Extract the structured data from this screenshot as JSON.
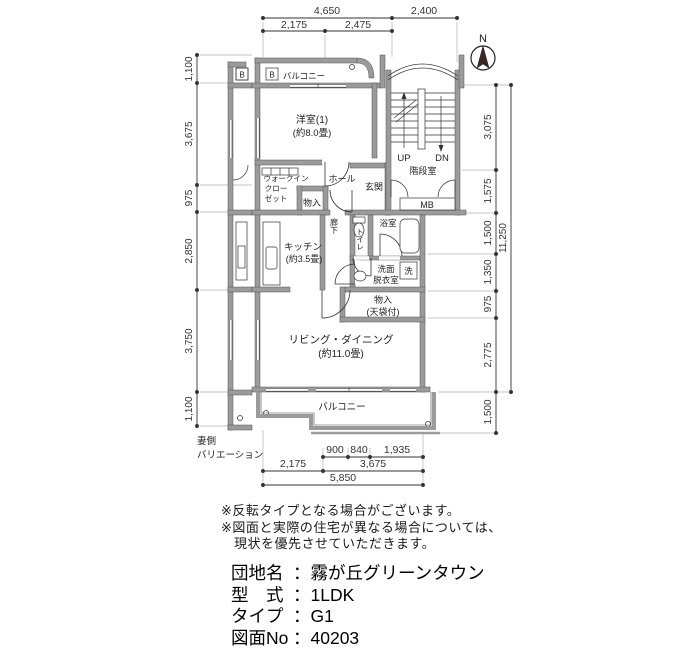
{
  "plan": {
    "compass": "N",
    "marker_b": "B",
    "rooms": {
      "balcony_top": "バルコニー",
      "western_room": "洋室(1)",
      "western_room_size": "(約8.0畳)",
      "wic_line1": "ウォークイン",
      "wic_line2": "クロー",
      "wic_line3": "ゼット",
      "storage_hall": "物入",
      "hall": "ホール",
      "entrance": "玄関",
      "stair_up": "UP",
      "stair_down": "DN",
      "stairwell": "階段室",
      "meter_box": "MB",
      "kitchen": "キッチン",
      "kitchen_size": "(約3.5畳)",
      "corridor": "廊下",
      "toilet": "トイレ",
      "bath": "浴室",
      "washroom_line1": "洗面",
      "washroom_line2": "脱衣室",
      "washer": "洗",
      "storage_living": "物入",
      "storage_living_note": "(天袋付)",
      "living": "リビング・ダイニング",
      "living_size": "(約11.0畳)",
      "balcony_bottom": "バルコニー"
    },
    "dims": {
      "top_row1": [
        "4,650",
        "2,400"
      ],
      "top_row2": [
        "2,175",
        "2,475"
      ],
      "left": [
        "1,100",
        "3,675",
        "975",
        "2,850",
        "3,750",
        "1,100"
      ],
      "right": [
        "3,075",
        "1,575",
        "1,500",
        "1,350",
        "975",
        "2,775",
        "1,500"
      ],
      "right_total": "11,250",
      "bottom_row1": [
        "900",
        "840",
        "1,935"
      ],
      "bottom_row2": [
        "2,175",
        "3,675"
      ],
      "bottom_row3": [
        "5,850"
      ]
    },
    "side_label_line1": "妻側",
    "side_label_line2": "バリエーション"
  },
  "notes": {
    "line1": "※反転タイプとなる場合がございます。",
    "line2": "※図面と実際の住宅が異なる場合については、",
    "line3": "現状を優先させていただきます。"
  },
  "info": {
    "separator": "：",
    "rows": [
      {
        "label": "団地名",
        "value": "霧が丘グリーンタウン"
      },
      {
        "label": "型　式",
        "value": "1LDK"
      },
      {
        "label": "タイプ",
        "value": "G1"
      },
      {
        "label": "図面No",
        "value": "40203"
      }
    ]
  },
  "colors": {
    "wall": "#9b9b9b",
    "line": "#333333",
    "needle": "#3a2727"
  }
}
